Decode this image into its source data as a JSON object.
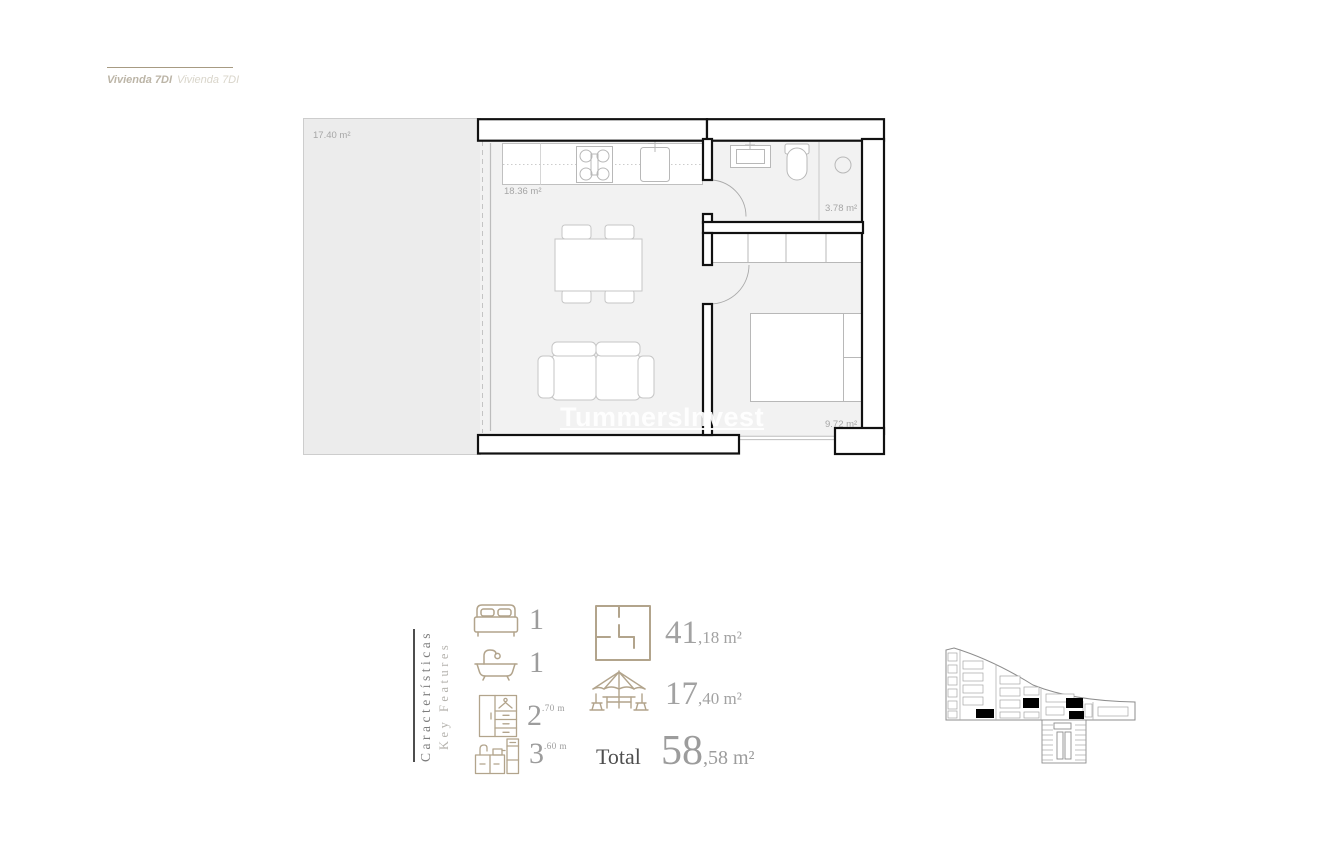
{
  "header": {
    "title_primary": "Vivienda 7DI",
    "title_secondary": "Vivienda 7DI"
  },
  "floor_plan": {
    "watermark": "TummersInvest",
    "terrace_area": "17.40 m²",
    "living_area": "18.36 m²",
    "bathroom_area": "3.78 m²",
    "bedroom_area": "9.72 m²"
  },
  "features": {
    "heading_es": "Características",
    "heading_en": "Key Features",
    "items": [
      {
        "icon": "bed-icon",
        "value": "1"
      },
      {
        "icon": "bath-icon",
        "value": "1"
      },
      {
        "icon": "wardrobe-icon",
        "value": "2",
        "sup": ".70 m"
      },
      {
        "icon": "kitchen-icon",
        "value": "3",
        "sup": ".60 m"
      }
    ],
    "areas": [
      {
        "icon": "floorplan-icon",
        "main": "41",
        "rest": ",18 m²"
      },
      {
        "icon": "terrace-icon",
        "main": "17",
        "rest": ",40 m²"
      }
    ],
    "total": {
      "label": "Total",
      "main": "58",
      "rest": ",58 m²"
    }
  },
  "colors": {
    "accent_tan": "#b2a48c",
    "wall_black": "#111111",
    "number_gray": "#9c9c9c",
    "unit_highlight": "#000000"
  }
}
